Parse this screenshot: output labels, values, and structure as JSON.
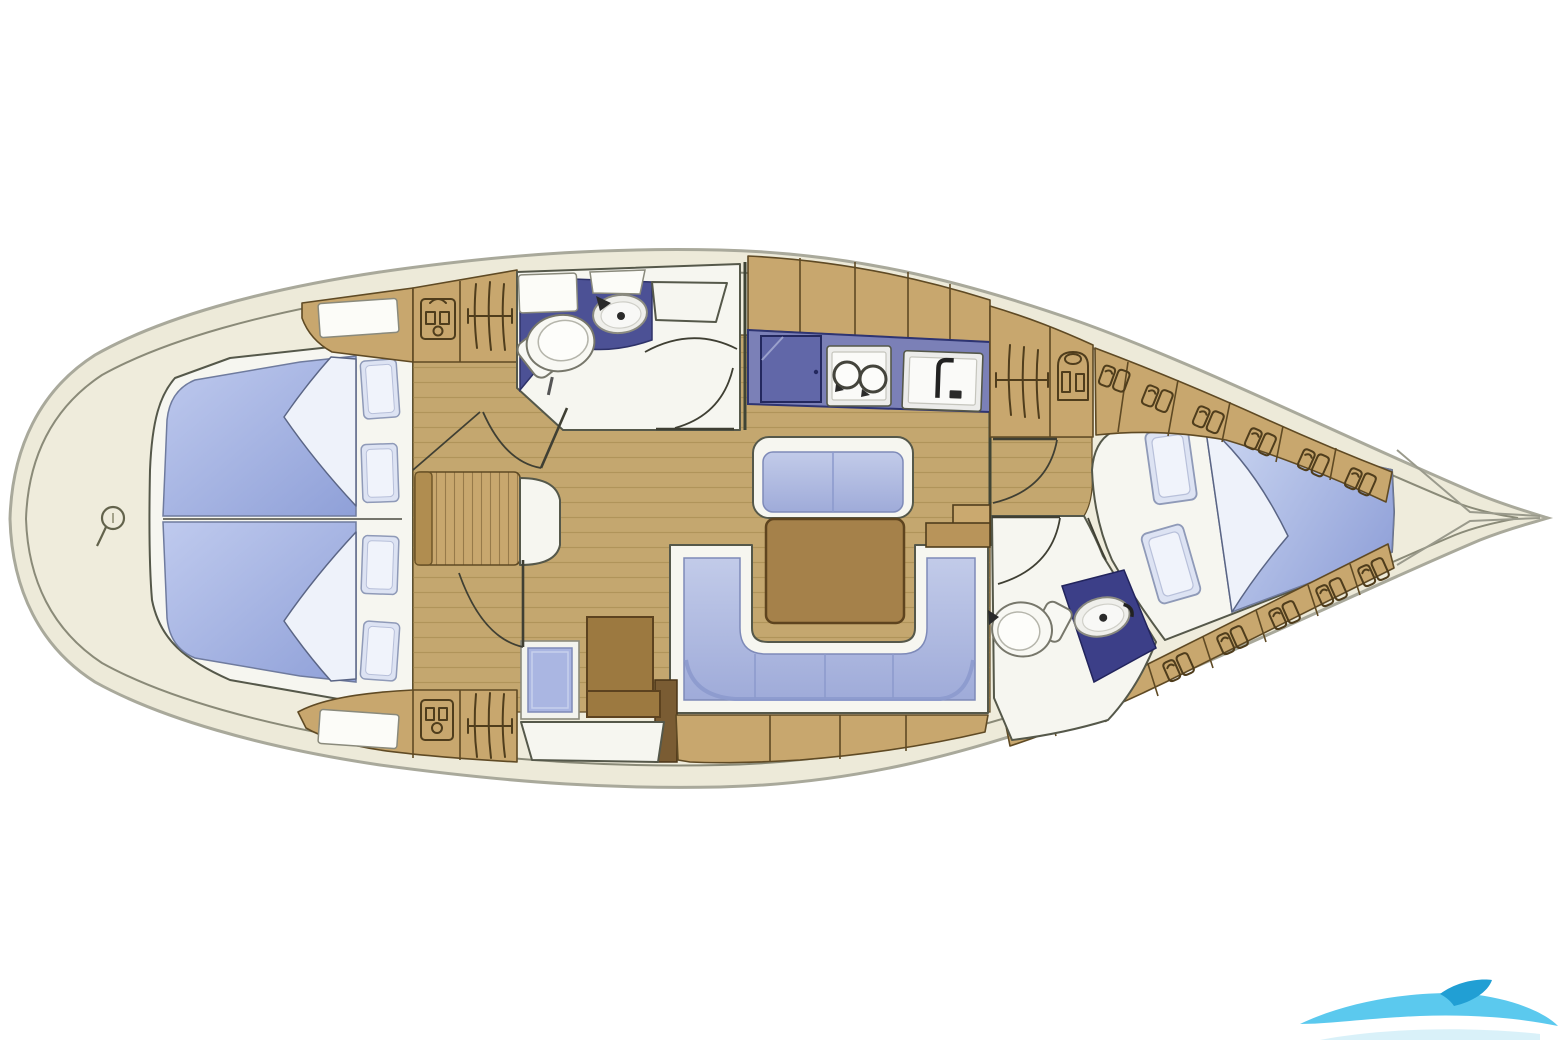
{
  "diagram": {
    "kind": "sailing-yacht-interior-floor-plan",
    "view": "top-down",
    "pointed_end": "right",
    "rounded_end": "left"
  },
  "colors": {
    "page_bg": "#ffffff",
    "hull_cream": "#edead9",
    "hull_edge": "#a9a99b",
    "hull_inner_line": "#8a8a78",
    "deck_inner": "#efecdc",
    "furn_white": "#f6f6f0",
    "line_dark": "#55584a",
    "wood": "#c8a76e",
    "wood_line": "#5f4a24",
    "floor": "#c4a76f",
    "grain": "#9c8145",
    "navy_fwd": "#4c5195",
    "navy_aft": "#3c3f88",
    "galley_blue": "#7b80b7",
    "fridge_blue": "#6167a8",
    "berth_light": "#bfcaee",
    "berth_deep": "#8fa0d8",
    "aftberth_light": "#cdd8f2",
    "aftberth_deep": "#94a4da",
    "cush_light": "#c2cbe9",
    "cush_deep": "#9fabd9",
    "fold_white": "#eef2fa",
    "pillow_frame": "#dde3f3",
    "pillow_fill": "#f0f3fb",
    "table_brown": "#a5814a",
    "chart_brown": "#9c7940",
    "seat_blue": "#aab6e2",
    "icon_line": "#4f3d1c",
    "wm_cyan": "#49c3ec",
    "wm_cyan_dark": "#219fd4",
    "wm_cyan_pale": "#bfe8f5"
  },
  "areas": [
    {
      "id": "left-cabin",
      "feature": "double-berth-two-mattresses-four-pillows-folded-blankets"
    },
    {
      "id": "forward-head",
      "features": [
        "toilet",
        "sink-basin",
        "shower-shelves",
        "door-swing"
      ]
    },
    {
      "id": "galley",
      "features": [
        "overhead-lockers",
        "fridge",
        "two-burner-stove",
        "sink-with-faucet"
      ]
    },
    {
      "id": "salon",
      "features": [
        "straight-bench",
        "dining-table",
        "u-shaped-settee",
        "base-cabinets",
        "drop-leaf-table",
        "stool"
      ]
    },
    {
      "id": "nav-station",
      "features": [
        "chart-table",
        "navigator-seat"
      ]
    },
    {
      "id": "companionway",
      "features": [
        "steps",
        "hanging-locker",
        "wardrobe"
      ]
    },
    {
      "id": "aft-head",
      "features": [
        "toilet",
        "sink-basin",
        "door-swing"
      ]
    },
    {
      "id": "right-cabin",
      "feature": "v-berth-two-pillows-folded-blanket-storage-shelves"
    }
  ],
  "icons": [
    "windlass-icon",
    "vanity-cabinet-icon",
    "hanging-locker-icon",
    "wardrobe-shirt-icon",
    "toilet-icon",
    "sink-basin-icon",
    "fridge-icon",
    "two-burner-stove-icon",
    "faucet-icon",
    "storage-items-icon",
    "watermark-swoosh"
  ],
  "watermark": {
    "position": "bottom-right",
    "color": "#49c3ec",
    "shape": "wave-swoosh"
  }
}
